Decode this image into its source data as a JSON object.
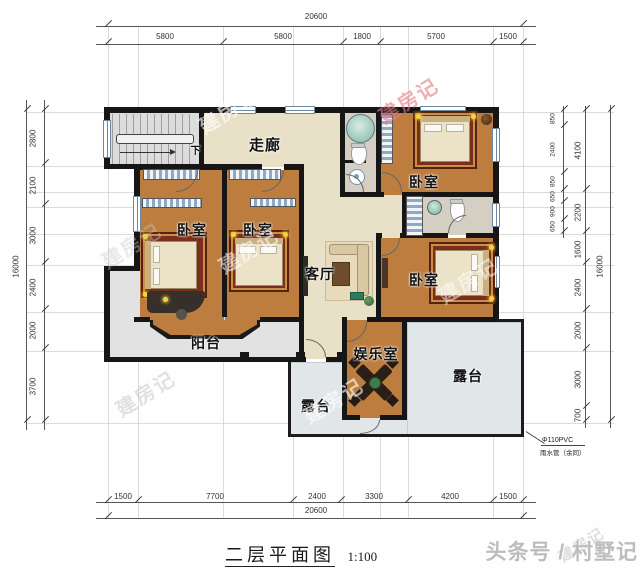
{
  "title": {
    "text": "二层平面图",
    "scale": "1:100"
  },
  "credit": "头条号 / 村墅记",
  "watermark": "建房记",
  "rooms": {
    "corridor": "走廊",
    "bedroom": "卧室",
    "living": "客厅",
    "balcony": "阳台",
    "entertainment": "娱乐室",
    "terrace": "露台",
    "stairs_down": "下"
  },
  "annotation": {
    "pipe": "Φ110PVC",
    "pipe_note": "雨水管（余同）"
  },
  "dimensions": {
    "top": {
      "total": "20600",
      "segments": [
        "5800",
        "5800",
        "1800",
        "5700",
        "1500"
      ]
    },
    "bottom": {
      "total": "20600",
      "segments": [
        "1500",
        "7700",
        "2400",
        "3300",
        "4200",
        "1500"
      ]
    },
    "left": {
      "total": "16000",
      "segments": [
        "2800",
        "2100",
        "3000",
        "2400",
        "2000",
        "3700"
      ]
    },
    "right": {
      "total": "16000",
      "inner": [
        "850",
        "2400",
        "850",
        "650",
        "900",
        "650"
      ],
      "outer": [
        "4100",
        "2200",
        "1600",
        "2400",
        "2000",
        "3000",
        "700"
      ]
    }
  }
}
